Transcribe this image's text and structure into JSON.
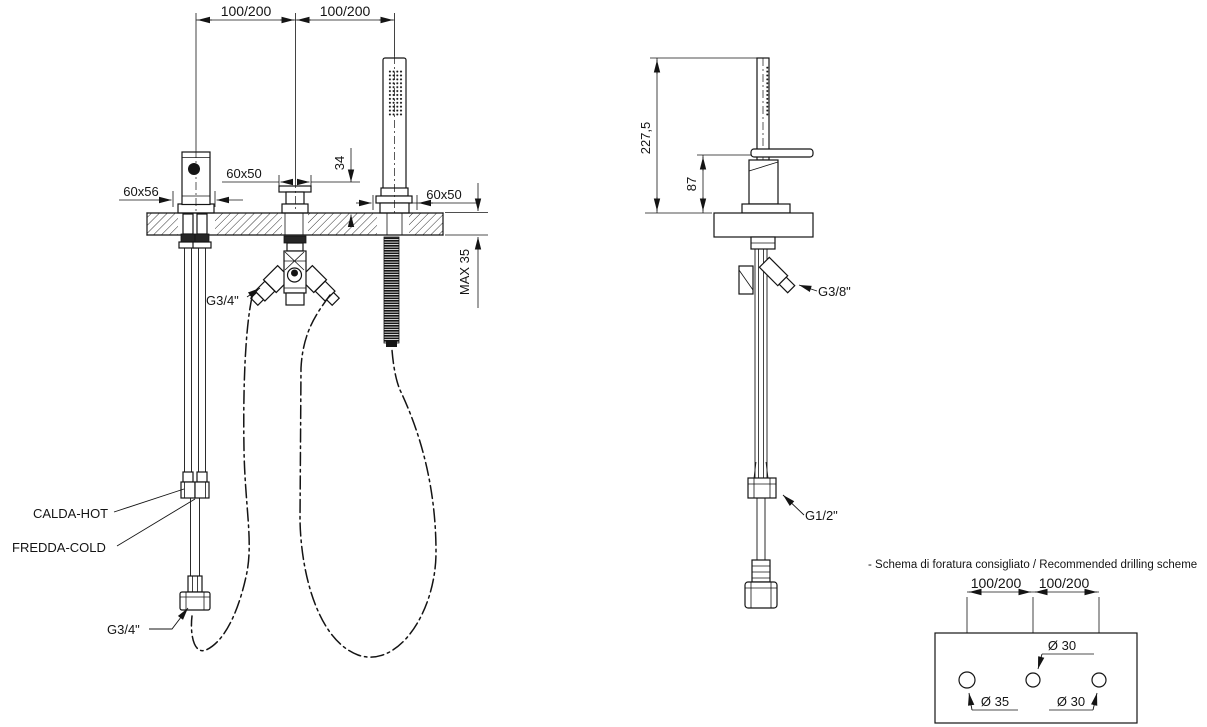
{
  "front_view": {
    "dim_span_left": "100/200",
    "dim_span_right": "100/200",
    "dim_handle_base": "60x56",
    "dim_spout_base": "60x50",
    "dim_spout_height": "34",
    "dim_shower_base": "60x50",
    "dim_deck_thickness": "MAX 35",
    "label_diverter_thread": "G3/4\"",
    "label_hot": "CALDA-HOT",
    "label_cold": "FREDDA-COLD",
    "label_outlet_hose_thread": "G3/4\""
  },
  "side_view": {
    "dim_overall_height": "227,5",
    "dim_handle_height": "87",
    "label_angle_connector_thread": "G3/8\"",
    "label_shower_hose_thread": "G1/2\""
  },
  "drilling_scheme": {
    "note": "- Schema di foratura consigliato / Recommended drilling scheme",
    "dim_span_left": "100/200",
    "dim_span_right": "100/200",
    "label_hole_middle": "Ø 30",
    "label_hole_left": "Ø 35",
    "label_hole_right": "Ø 30"
  }
}
